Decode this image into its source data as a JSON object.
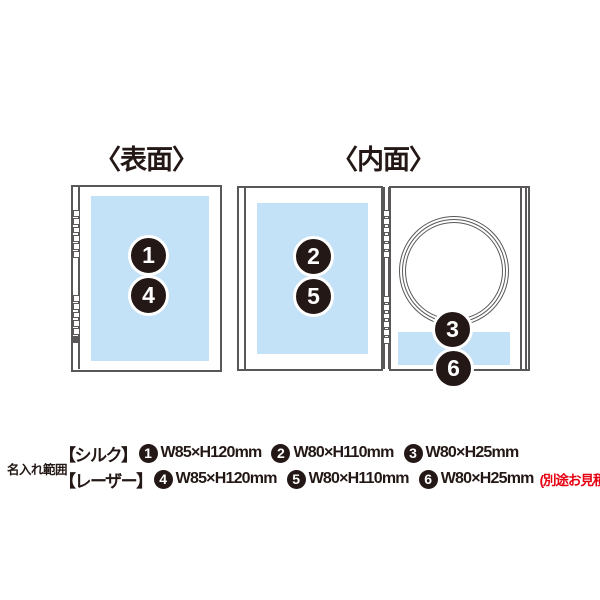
{
  "colors": {
    "print_area_blue": "#c3e2f8",
    "outline_gray": "#595757",
    "badge_black": "#231815",
    "note_red": "#e60012",
    "background": "#ffffff"
  },
  "diagram": {
    "front_title": "〈表面〉",
    "inner_title": "〈内面〉",
    "badges": {
      "b1": "1",
      "b2": "2",
      "b3": "3",
      "b4": "4",
      "b5": "5",
      "b6": "6"
    }
  },
  "legend": {
    "label": "名入れ範囲",
    "rows": [
      {
        "method": "【シルク】",
        "items": [
          {
            "num": "1",
            "size": "W85×H120mm"
          },
          {
            "num": "2",
            "size": "W80×H110mm"
          },
          {
            "num": "3",
            "size": "W80×H25mm"
          }
        ],
        "note": ""
      },
      {
        "method": "【レーザー】",
        "items": [
          {
            "num": "4",
            "size": "W85×H120mm"
          },
          {
            "num": "5",
            "size": "W80×H110mm"
          },
          {
            "num": "6",
            "size": "W80×H25mm"
          }
        ],
        "note": "(別途お見積り)"
      }
    ]
  }
}
